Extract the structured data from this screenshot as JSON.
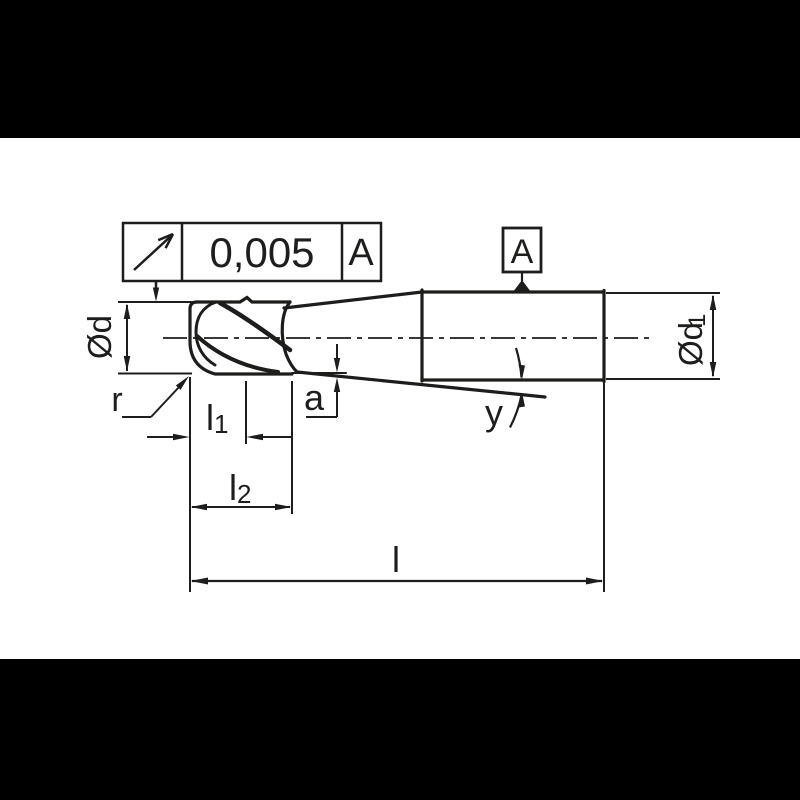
{
  "colors": {
    "page_background": "#000000",
    "drawing_background": "#ffffff",
    "line_color": "#1d1d1b"
  },
  "tolerance_frame": {
    "symbol_icon": "circular-runout-arrow",
    "value": "0,005",
    "datum_ref": "A"
  },
  "datum_flag": {
    "label": "A"
  },
  "labels": {
    "diameter_d": {
      "base": "Ød"
    },
    "diameter_d1": {
      "base": "Ød",
      "sub": "1"
    },
    "corner_radius": {
      "base": "r"
    },
    "flute_length": {
      "base": "l",
      "sub": "1"
    },
    "cut_length": {
      "base": "l",
      "sub": "2"
    },
    "overall_length": {
      "base": "l"
    },
    "taper_offset": {
      "base": "a"
    },
    "taper_angle": {
      "base": "y"
    }
  }
}
